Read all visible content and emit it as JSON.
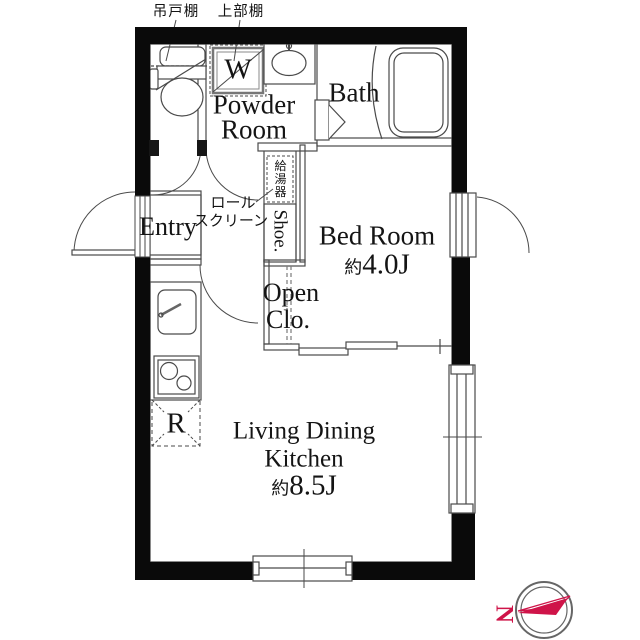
{
  "colors": {
    "wall_black": "#0a0a0a",
    "line_gray": "#4a4a4a",
    "compass_red": "#cf1449"
  },
  "annotations": {
    "hanging_cupboard": "吊戸棚",
    "upper_shelf": "上部棚",
    "roll_screen_line1": "ロール",
    "roll_screen_line2": "スクリーン",
    "water_heater": "給湯器"
  },
  "rooms": {
    "powder_room": {
      "line1": "Powder",
      "line2": "Room"
    },
    "bath": {
      "label": "Bath"
    },
    "entry": {
      "label": "Entry"
    },
    "shoe": {
      "label": "Shoe."
    },
    "bed_room": {
      "label": "Bed Room",
      "size_prefix": "約",
      "size_value": "4.0J"
    },
    "open_closet": {
      "line1": "Open",
      "line2": "Clo."
    },
    "ldk": {
      "line1": "Living Dining",
      "line2": "Kitchen",
      "size_prefix": "約",
      "size_value": "8.5J"
    }
  },
  "fixtures": {
    "washing_machine": "W",
    "refrigerator": "R"
  },
  "compass": {
    "letter": "N"
  }
}
